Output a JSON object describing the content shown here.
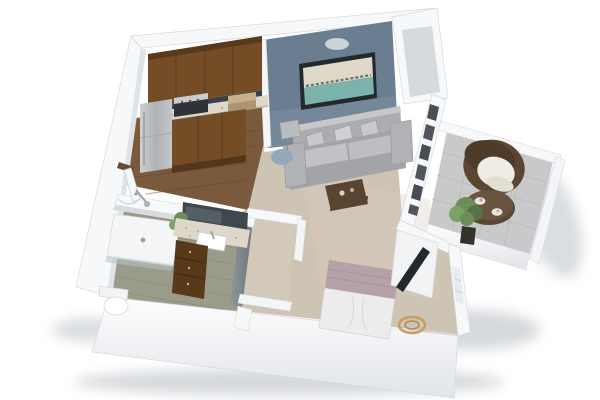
{
  "scene": {
    "title": "3D floor plan rendering of a studio apartment",
    "view": "isometric dollhouse cutaway, floating on white background",
    "rooms": [
      {
        "name": "Kitchen",
        "floor": "dark wood planks"
      },
      {
        "name": "Living room",
        "floor": "beige carpet",
        "feature": "slate-blue accent wall with framed abstract art"
      },
      {
        "name": "Sleeping area",
        "floor": "beige carpet"
      },
      {
        "name": "Bathroom",
        "floor": "sage tile"
      },
      {
        "name": "Walk-in closet",
        "floor": "beige carpet"
      },
      {
        "name": "Balcony",
        "floor": "gray pavers"
      }
    ],
    "furniture": [
      "refrigerator",
      "range",
      "upper-cabinets",
      "lower-cabinets",
      "kitchen-counter",
      "sofa",
      "throw-pillows",
      "floor-lamp",
      "blue-pouf",
      "coffee-table",
      "wall-art",
      "tv",
      "tv-console",
      "bed",
      "storage-basket",
      "vanity-mirror",
      "vanity-sink",
      "vanity-drawers",
      "vanity-plant",
      "walk-in-shower",
      "shower-head",
      "toilet",
      "wicker-armchair",
      "patio-table",
      "potted-plant",
      "entry-door"
    ]
  },
  "palette": {
    "background": "#ffffff",
    "wall_top": "#f7f8fa",
    "wall_face": "#eceef1",
    "wall_shade": "#d6dade",
    "niche_floor": "#d7dadd",
    "accent_wall": "#6b7e91",
    "accent_wall_light": "#8195a7",
    "carpet": "#cec4b4",
    "wood_floor": "#7b593d",
    "wood_line": "#63462e",
    "tile_floor": "#9b9b89",
    "tile_line": "#878776",
    "paver": "#c8c9cb",
    "paver_line": "#b4b6b9",
    "cabinet_wood": "#744d26",
    "cabinet_wood_dark": "#58391a",
    "counter": "#ded7ca",
    "backsplash": "#3c4146",
    "fridge": "#b7babd",
    "sofa": "#a2a4a7",
    "sofa_back": "#abadb0",
    "sofa_light": "#c0c2c4",
    "pillow": "#c7c9cb",
    "coffee_table": "#5a4431",
    "art_frame": "#24292d",
    "art_teal": "#7ab3ab",
    "art_cream": "#ded9c9",
    "blanket": "#b4a2a8",
    "duvet": "#ececee",
    "tv": "#24282d",
    "console_white": "#f2f3f5",
    "wicker": "#5a4632",
    "cushion": "#efece3",
    "plant": "#6c8d58",
    "plant_dark": "#567345",
    "pot": "#35322e",
    "basket": "#c89f62",
    "glass": "#b9c4c9",
    "chrome": "#9aa0a4",
    "sink": "#ffffff",
    "shadow": "#aeb4ba",
    "pouf_blue": "#93a9ba",
    "lamp_shade": "#b9bdc0"
  }
}
